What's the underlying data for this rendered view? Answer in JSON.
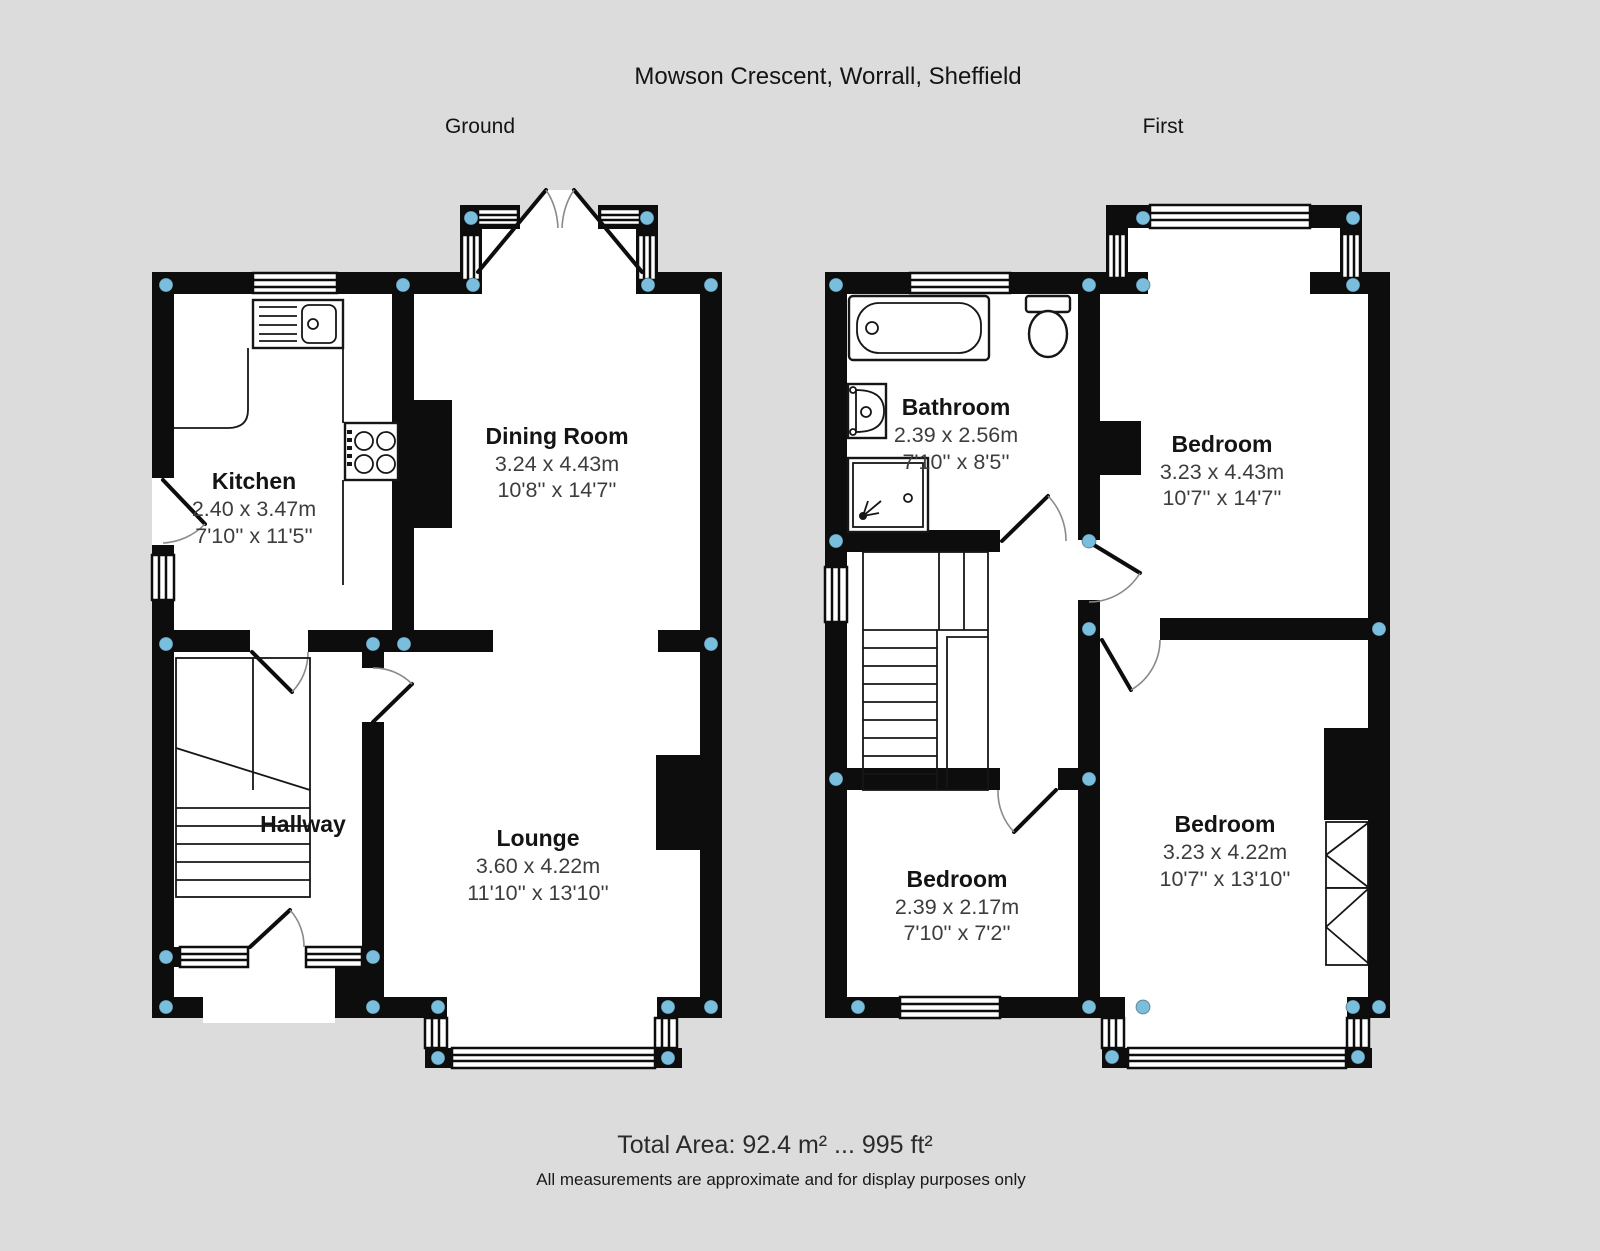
{
  "title": "Mowson Crescent, Worrall, Sheffield",
  "floors": {
    "ground": {
      "label": "Ground",
      "rooms": {
        "kitchen": {
          "name": "Kitchen",
          "metric": "2.40 x 3.47m",
          "imperial": "7'10'' x 11'5''"
        },
        "dining_room": {
          "name": "Dining Room",
          "metric": "3.24 x 4.43m",
          "imperial": "10'8'' x 14'7''"
        },
        "hallway": {
          "name": "Hallway"
        },
        "lounge": {
          "name": "Lounge",
          "metric": "3.60 x 4.22m",
          "imperial": "11'10'' x 13'10''"
        }
      }
    },
    "first": {
      "label": "First",
      "rooms": {
        "bathroom": {
          "name": "Bathroom",
          "metric": "2.39 x 2.56m",
          "imperial": "7'10'' x 8'5''"
        },
        "bedroom_front": {
          "name": "Bedroom",
          "metric": "3.23 x 4.43m",
          "imperial": "10'7'' x 14'7''"
        },
        "bedroom_small": {
          "name": "Bedroom",
          "metric": "2.39 x 2.17m",
          "imperial": "7'10'' x 7'2''"
        },
        "bedroom_rear": {
          "name": "Bedroom",
          "metric": "3.23 x 4.22m",
          "imperial": "10'7'' x 13'10''"
        }
      }
    }
  },
  "footer": {
    "total_area": "Total Area: 92.4 m² ... 995 ft²",
    "disclaimer": "All measurements are approximate and for display purposes only"
  },
  "colors": {
    "background": "#dcdcdc",
    "floor": "#ffffff",
    "wall": "#0d0d0d",
    "corner_dot": "#79bedd",
    "dimension_text": "#3d3d3d",
    "label_text": "#141414"
  }
}
